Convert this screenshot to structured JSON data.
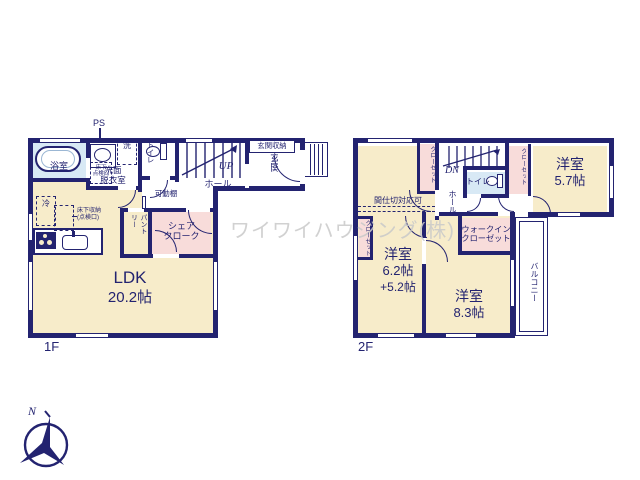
{
  "watermark": "ワイワイハウジング(株)",
  "compass": {
    "north_label": "N"
  },
  "colors": {
    "wall": "#232370",
    "room_cream": "#f7ecca",
    "closet_pink": "#f8dcda",
    "wet_area_blue": "#d8e9f5",
    "watermark_gray": "#c9c9c9"
  },
  "floor1": {
    "floor_label": "1F",
    "bath": "浴室",
    "ps": "PS",
    "washer": "洗",
    "washroom": "洗面\n脱衣室",
    "underfloor_hatch": "床下\n点検口",
    "toilet": "トイレ",
    "stairs": "UP",
    "hall": "ホール",
    "movable_shelf": "可動棚",
    "entrance_storage": "玄関収納",
    "entrance": "玄関",
    "fridge": "冷",
    "underfloor_storage": "床下収納\n(点検口)",
    "pantry": "パントリー",
    "share_cloak": "シェア\nクローク",
    "ldk_name": "LDK",
    "ldk_size": "20.2帖"
  },
  "floor2": {
    "floor_label": "2F",
    "closet_left": "クローゼット",
    "stairs": "DN",
    "toilet": "トイレ",
    "hall": "ホール",
    "closet_right": "クローゼット",
    "room1_name": "洋室",
    "room1_size": "5.7帖",
    "partition_note": "間仕切対応可",
    "closet_small": "クローゼット",
    "wic": "ウォークイン\nクローゼット",
    "room2_name": "洋室",
    "room2_size": "6.2帖",
    "room2_size_extra": "+5.2帖",
    "room3_name": "洋室",
    "room3_size": "8.3帖",
    "balcony": "バルコニー"
  }
}
